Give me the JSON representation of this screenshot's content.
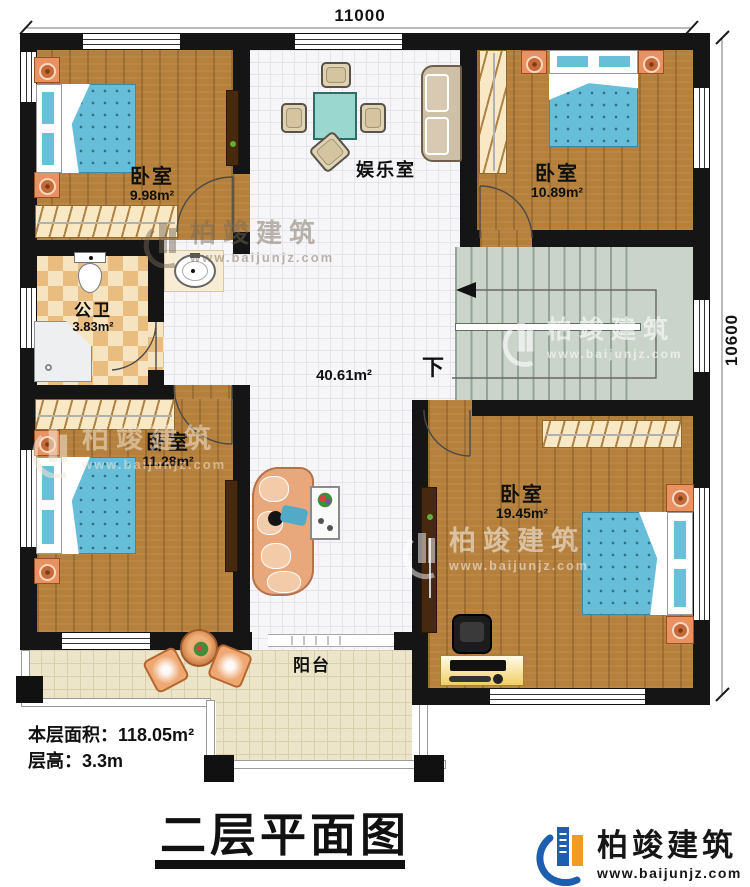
{
  "dimensions": {
    "top": "11000",
    "right": "10600"
  },
  "rooms": {
    "bedroom_tl": {
      "label": "卧室",
      "area": "9.98m²"
    },
    "bedroom_tr": {
      "label": "卧室",
      "area": "10.89m²"
    },
    "bedroom_bl": {
      "label": "卧室",
      "area": "11.28m²"
    },
    "bedroom_br": {
      "label": "卧室",
      "area": "19.45m²"
    },
    "entertainment": {
      "label": "娱乐室"
    },
    "bathroom": {
      "label": "公卫",
      "area": "3.83m²"
    },
    "hall": {
      "area": "40.61m²"
    },
    "balcony": {
      "label": "阳台"
    },
    "stairs": {
      "down": "下"
    }
  },
  "info": {
    "area_label": "本层面积：",
    "area_value": "118.05m²",
    "height_label": "层高：",
    "height_value": "3.3m"
  },
  "title": {
    "text": "二层平面图"
  },
  "brand": {
    "name": "柏竣建筑",
    "url": "www.baijunjz.com"
  },
  "colors": {
    "wall": "#151515",
    "wood": "#b5803c",
    "tile": "#f6f6f8",
    "checker_dark": "#e9bd80",
    "checker_light": "#f6e3c0",
    "stairs": "#cbd4ca",
    "balcony": "#ece5ca",
    "bed_blanket": "#66bed8",
    "brand_blue": "#1d5fae",
    "brand_orange": "#f59b20"
  }
}
